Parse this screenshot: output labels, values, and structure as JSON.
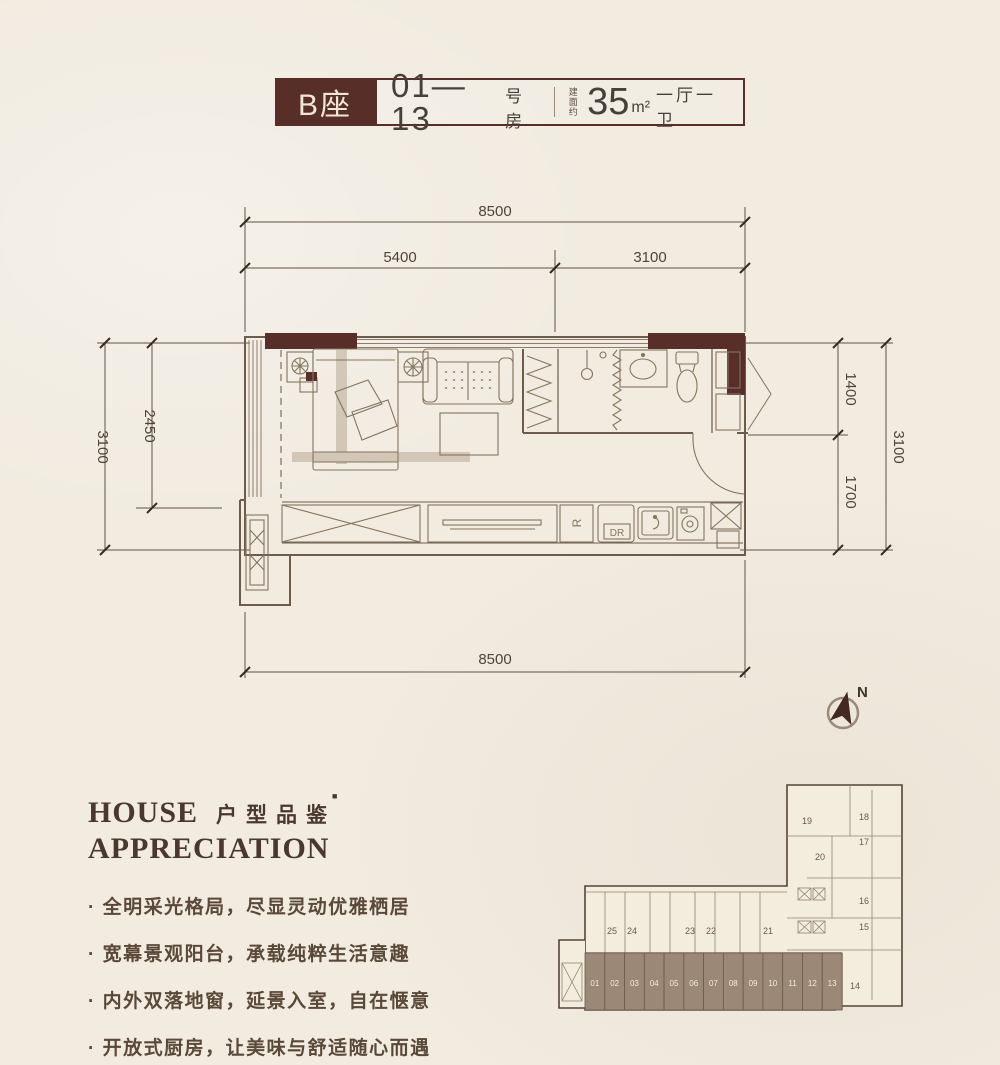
{
  "header": {
    "block_name": "B座",
    "room_range": "01—13",
    "room_suffix": "号房",
    "area_label_line1": "建面",
    "area_label_line2": "约",
    "area_value": "35",
    "area_unit": "m²",
    "layout_type": "一厅一卫"
  },
  "floorplan": {
    "dim_top_total": "8500",
    "dim_top_left": "5400",
    "dim_top_right": "3100",
    "dim_left_outer": "3100",
    "dim_left_inner": "2450",
    "dim_right_top": "1400",
    "dim_right_bottom": "1700",
    "dim_right_outer": "3100",
    "dim_bottom_total": "8500",
    "fridge_label": "R",
    "dryer_label": "DR"
  },
  "compass": {
    "north_label": "N"
  },
  "section_title": {
    "english_line1": "HOUSE",
    "english_line2": "APPRECIATION",
    "chinese": "户型品鉴",
    "seal_mark": "■"
  },
  "features": [
    "· 全明采光格局，尽显灵动优雅栖居",
    "· 宽幕景观阳台，承载纯粹生活意趣",
    "· 内外双落地窗，延景入室，自在惬意",
    "· 开放式厨房，让美味与舒适随心而遇"
  ],
  "keyplan": {
    "highlighted_units": [
      "01",
      "02",
      "03",
      "04",
      "05",
      "06",
      "07",
      "08",
      "09",
      "10",
      "11",
      "12",
      "13"
    ],
    "upper_row_units": [
      "25",
      "24",
      "23",
      "22",
      "21"
    ],
    "tower_units": [
      "19",
      "18",
      "17",
      "20",
      "16",
      "15",
      "14"
    ],
    "highlight_color": "#9c8877"
  },
  "colors": {
    "background": "#f1ebe0",
    "accent_dark_brown": "#572f28",
    "wall_line": "#6b5c4c",
    "dimension_text": "#4f4437"
  }
}
